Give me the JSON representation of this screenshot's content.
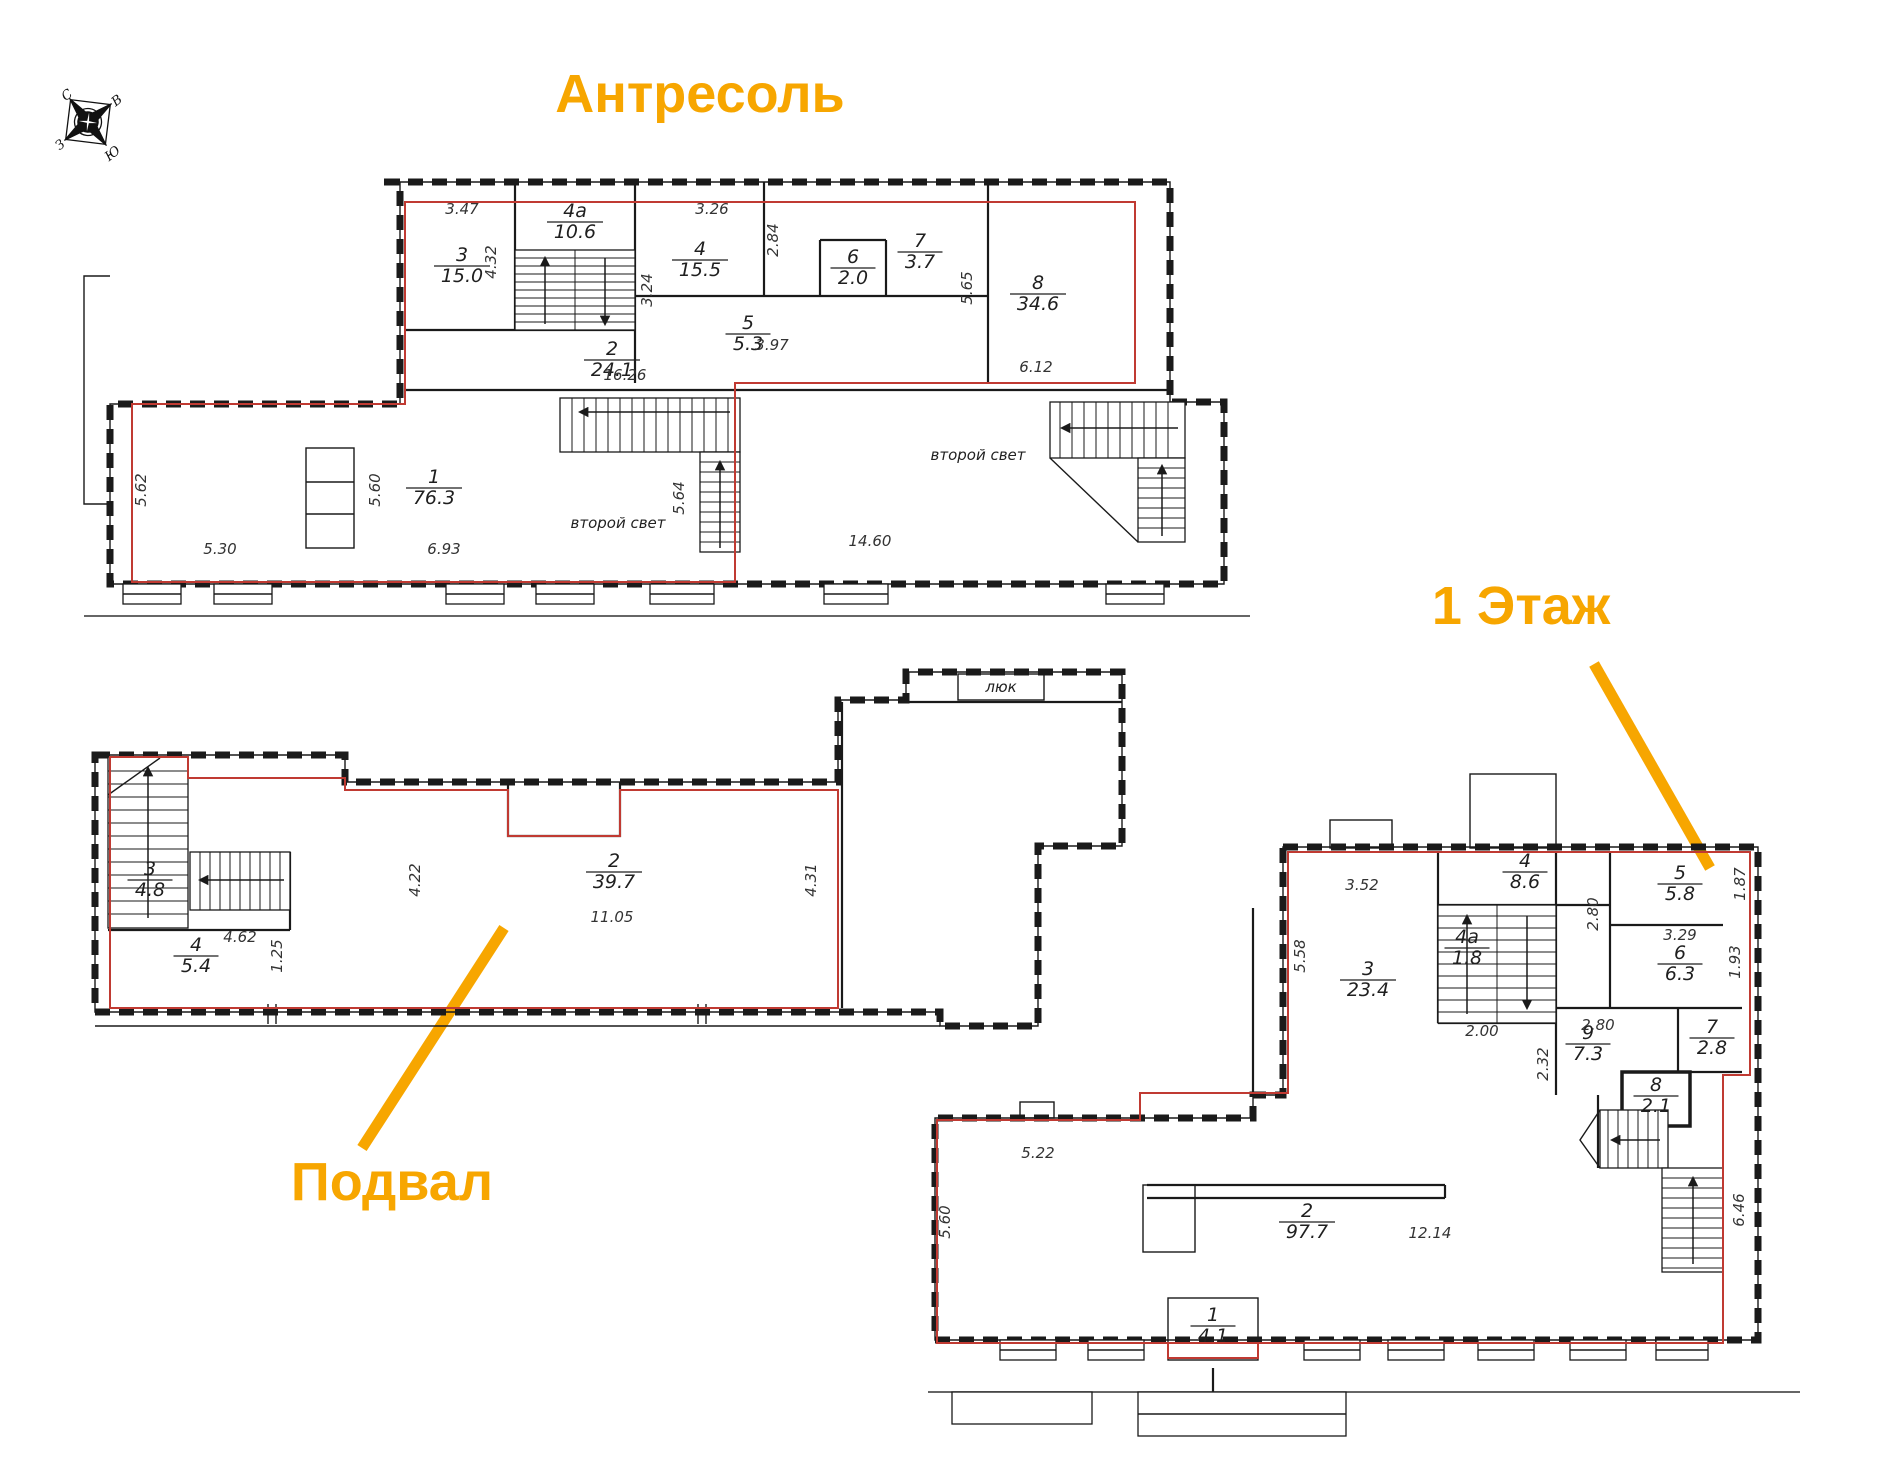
{
  "titles": {
    "mezzanine": "Антресоль",
    "first_floor": "1 Этаж",
    "basement": "Подвал"
  },
  "compass": {
    "north": "С",
    "east": "В",
    "south": "Ю",
    "west": "З"
  },
  "colors": {
    "accent": "#F7A600",
    "boundary": "#C03A32",
    "wall": "#1A1A1A"
  },
  "floors": {
    "mezzanine": {
      "rooms": [
        {
          "num": "3",
          "area": "15.0",
          "x": 462,
          "y": 266
        },
        {
          "num": "4а",
          "area": "10.6",
          "x": 575,
          "y": 222
        },
        {
          "num": "4",
          "area": "15.5",
          "x": 700,
          "y": 260
        },
        {
          "num": "5",
          "area": "5.3",
          "x": 748,
          "y": 334
        },
        {
          "num": "6",
          "area": "2.0",
          "x": 853,
          "y": 268
        },
        {
          "num": "7",
          "area": "3.7",
          "x": 920,
          "y": 252
        },
        {
          "num": "8",
          "area": "34.6",
          "x": 1038,
          "y": 294
        },
        {
          "num": "2",
          "area": "24.1",
          "x": 612,
          "y": 360
        },
        {
          "num": "1",
          "area": "76.3",
          "x": 434,
          "y": 488
        }
      ],
      "dims": [
        {
          "text": "3.47",
          "x": 462,
          "y": 214
        },
        {
          "text": "4.32",
          "x": 496,
          "y": 262,
          "rotate": true
        },
        {
          "text": "3.24",
          "x": 652,
          "y": 290,
          "rotate": true
        },
        {
          "text": "3.26",
          "x": 712,
          "y": 214
        },
        {
          "text": "2.84",
          "x": 778,
          "y": 240,
          "rotate": true
        },
        {
          "text": "3.97",
          "x": 772,
          "y": 350
        },
        {
          "text": "5.65",
          "x": 972,
          "y": 288,
          "rotate": true
        },
        {
          "text": "6.12",
          "x": 1036,
          "y": 372
        },
        {
          "text": "16.26",
          "x": 625,
          "y": 380
        },
        {
          "text": "5.62",
          "x": 146,
          "y": 490,
          "rotate": true
        },
        {
          "text": "5.60",
          "x": 380,
          "y": 490,
          "rotate": true
        },
        {
          "text": "5.30",
          "x": 220,
          "y": 554
        },
        {
          "text": "6.93",
          "x": 444,
          "y": 554
        },
        {
          "text": "5.64",
          "x": 684,
          "y": 498,
          "rotate": true
        },
        {
          "text": "14.60",
          "x": 870,
          "y": 546
        }
      ],
      "notes": [
        {
          "text": "второй свет",
          "x": 618,
          "y": 528
        },
        {
          "text": "второй свет",
          "x": 978,
          "y": 460
        }
      ]
    },
    "basement": {
      "rooms": [
        {
          "num": "3",
          "area": "4.8",
          "x": 150,
          "y": 880
        },
        {
          "num": "4",
          "area": "5.4",
          "x": 196,
          "y": 956
        },
        {
          "num": "2",
          "area": "39.7",
          "x": 614,
          "y": 872
        }
      ],
      "dims": [
        {
          "text": "4.62",
          "x": 240,
          "y": 942
        },
        {
          "text": "1.25",
          "x": 282,
          "y": 956,
          "rotate": true
        },
        {
          "text": "4.22",
          "x": 420,
          "y": 880,
          "rotate": true
        },
        {
          "text": "11.05",
          "x": 612,
          "y": 922
        },
        {
          "text": "4.31",
          "x": 816,
          "y": 880,
          "rotate": true
        }
      ],
      "notes": [
        {
          "text": "люк",
          "x": 1001,
          "y": 692
        }
      ]
    },
    "first_floor": {
      "rooms": [
        {
          "num": "3",
          "area": "23.4",
          "x": 1368,
          "y": 980
        },
        {
          "num": "4а",
          "area": "1.8",
          "x": 1467,
          "y": 948
        },
        {
          "num": "4",
          "area": "8.6",
          "x": 1525,
          "y": 872
        },
        {
          "num": "5",
          "area": "5.8",
          "x": 1680,
          "y": 884
        },
        {
          "num": "6",
          "area": "6.3",
          "x": 1680,
          "y": 964
        },
        {
          "num": "9",
          "area": "7.3",
          "x": 1588,
          "y": 1044
        },
        {
          "num": "7",
          "area": "2.8",
          "x": 1712,
          "y": 1038
        },
        {
          "num": "8",
          "area": "2.1",
          "x": 1656,
          "y": 1096
        },
        {
          "num": "2",
          "area": "97.7",
          "x": 1307,
          "y": 1222
        },
        {
          "num": "1",
          "area": "4.1",
          "x": 1213,
          "y": 1326
        }
      ],
      "dims": [
        {
          "text": "3.52",
          "x": 1362,
          "y": 890
        },
        {
          "text": "5.58",
          "x": 1305,
          "y": 956,
          "rotate": true
        },
        {
          "text": "2.00",
          "x": 1482,
          "y": 1036
        },
        {
          "text": "2.80",
          "x": 1598,
          "y": 914,
          "rotate": true
        },
        {
          "text": "1.87",
          "x": 1745,
          "y": 884,
          "rotate": true
        },
        {
          "text": "3.29",
          "x": 1680,
          "y": 940
        },
        {
          "text": "1.93",
          "x": 1740,
          "y": 962,
          "rotate": true
        },
        {
          "text": "2.80",
          "x": 1598,
          "y": 1030
        },
        {
          "text": "2.32",
          "x": 1548,
          "y": 1064,
          "rotate": true
        },
        {
          "text": "12.14",
          "x": 1430,
          "y": 1238
        },
        {
          "text": "5.22",
          "x": 1038,
          "y": 1158
        },
        {
          "text": "5.60",
          "x": 950,
          "y": 1222,
          "rotate": true
        },
        {
          "text": "6.46",
          "x": 1744,
          "y": 1210,
          "rotate": true
        }
      ],
      "notes": []
    }
  }
}
